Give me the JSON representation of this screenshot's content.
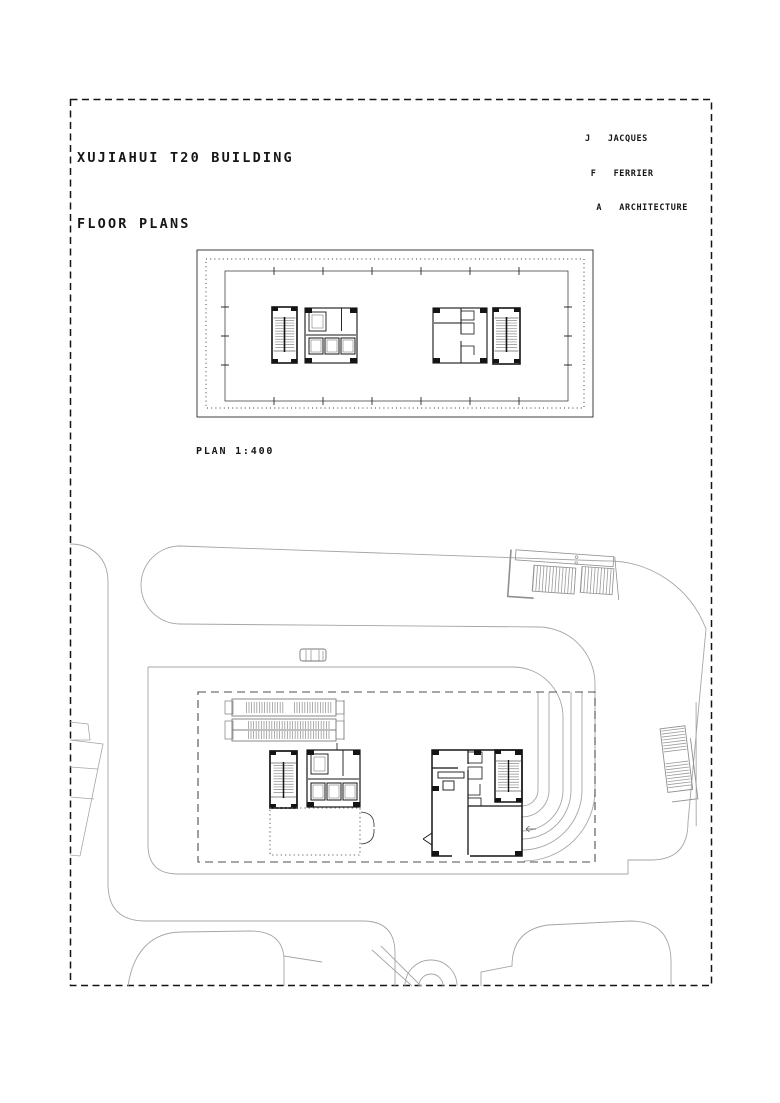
{
  "sheet": {
    "title": {
      "line1": "XUJIAHUI T20 BUILDING",
      "line2": "FLOOR PLANS"
    },
    "firm": {
      "line1": "J   JACQUES",
      "line2": " F   FERRIER",
      "line3": "  A   ARCHITECTURE"
    },
    "plan_label": "PLAN 1:400",
    "scale": "1:400",
    "colors": {
      "ink": "#1c1c1c",
      "wall_black": "#141414",
      "site_line": "#a6a6a6",
      "hatch_gray": "#8c8c8c",
      "paper": "#ffffff"
    },
    "drawings": [
      {
        "id": "typical-floor-plan",
        "description": "typical tower floor: facade mullion ring, column grid, two cores (stairs, elevators, service rooms)"
      },
      {
        "id": "ground-site-plan",
        "description": "ground level: site roads, drop-off arcs, metro stair, escalators, lobby cores, car, dashed tower footprint"
      }
    ]
  }
}
